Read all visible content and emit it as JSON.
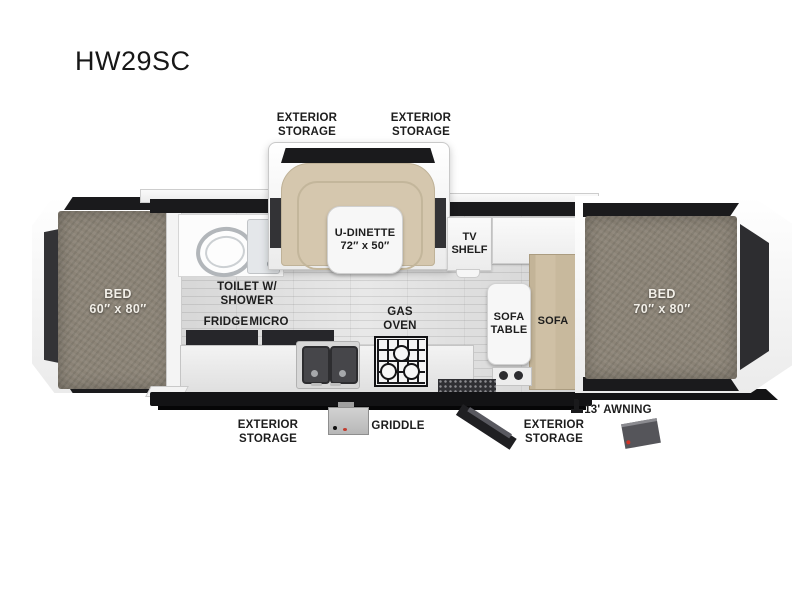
{
  "title": "HW29SC",
  "labels": {
    "exterior_storage": "EXTERIOR\nSTORAGE",
    "bed_left": "BED\n60″ x 80″",
    "toilet_shower": "TOILET W/\nSHOWER",
    "u_dinette": "U-DINETTE\n72″ x 50″",
    "tv_shelf": "TV\nSHELF",
    "fridge": "FRIDGE",
    "micro": "MICRO",
    "gas_oven": "GAS\nOVEN",
    "sofa_table": "SOFA\nTABLE",
    "sofa": "SOFA",
    "bed_right": "BED\n70″ x 80″",
    "griddle": "GRIDDLE",
    "awning": "13' AWNING"
  },
  "colors": {
    "label-text": "#1d1d1d",
    "bed-label-text": "#f2efe8",
    "mattress": "#8c8477",
    "dark-trim": "#1a1a1c",
    "window-dark": "#333336",
    "bench-tan": "#d5c7ae",
    "sofa-tan": "#c9baa0",
    "floor-gray": "#dcdcdc",
    "shell-white": "#fbfbfb"
  }
}
